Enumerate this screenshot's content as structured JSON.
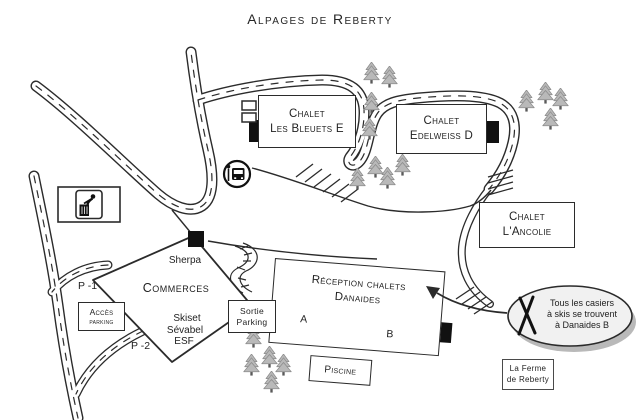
{
  "title": "Alpages de Reberty",
  "chalets": {
    "bleuets": {
      "line1": "Chalet",
      "line2": "Les Bleuets E"
    },
    "edelweiss": {
      "line1": "Chalet",
      "line2": "Edelweiss D"
    },
    "ancolie": {
      "line1": "Chalet",
      "line2": "L'Ancolie"
    }
  },
  "reception": {
    "line1": "Réception chalets",
    "line2": "Danaides",
    "unit_a": "A",
    "unit_b": "B",
    "piscine": "Piscine"
  },
  "commerce": {
    "sherpa": "Sherpa",
    "title": "Commerces",
    "skiset": "Skiset",
    "sevabel": "Sévabel",
    "esf": "ESF"
  },
  "parking": {
    "p1": "P -1",
    "p2": "P -2",
    "acces_line1": "Accès",
    "acces_line2": "parking",
    "sortie_line1": "Sortie",
    "sortie_line2": "Parking"
  },
  "ferme": {
    "line1": "La Ferme",
    "line2": "de Reberty"
  },
  "bubble": {
    "line1": "Tous les casiers",
    "line2": "à skis se trouvent",
    "line3": "à Danaides B"
  },
  "icons": {
    "trash": "trash-disposal-icon",
    "bus": "bus-stop-icon",
    "skis": "crossed-skis-icon",
    "tree": "pine-tree-icon"
  },
  "colors": {
    "line": "#2b2b2b",
    "tree_fill": "#b9b9b9",
    "tree_stroke": "#8d8d8d",
    "bubble_fill": "#f1f1f1",
    "bubble_shadow": "#b9b9b9"
  }
}
